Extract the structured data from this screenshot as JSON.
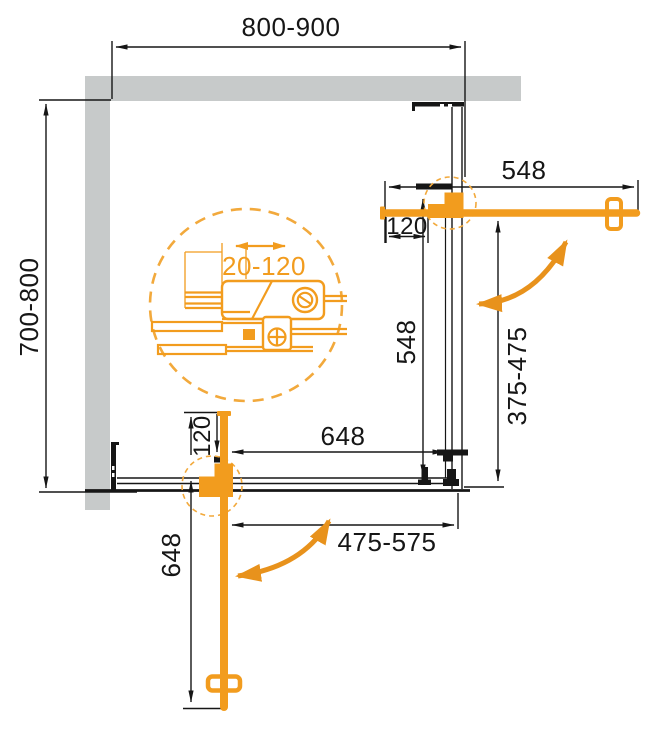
{
  "drawing": {
    "title": "Corner shower enclosure - top view technical drawing",
    "labels": {
      "top_width": "800-900",
      "left_depth": "700-800",
      "door_right_width": "548",
      "door_right_closed": "548",
      "opening_right": "375-475",
      "panel_bottom_width": "648",
      "door_bottom_length": "648",
      "opening_bottom": "475-575",
      "pivot_offset_right": "120",
      "pivot_offset_bottom": "120",
      "adjustment_range": "20-120"
    },
    "colors": {
      "accent": "#F29C1E",
      "accent_dark": "#E8921C",
      "accent_dash": "#F2A93C",
      "wall": "#C7CACA",
      "line": "#161616"
    }
  }
}
